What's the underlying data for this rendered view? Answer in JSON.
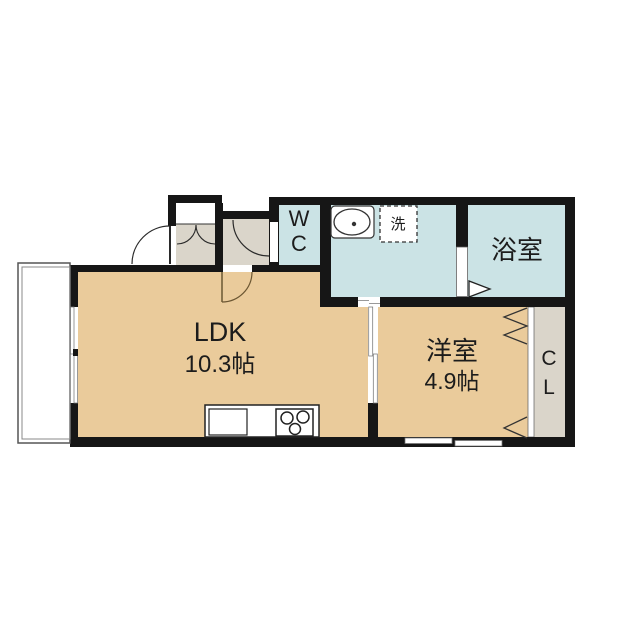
{
  "plan": {
    "ldk": {
      "label": "LDK",
      "area": "10.3帖"
    },
    "western_room": {
      "label": "洋室",
      "area": "4.9帖"
    },
    "bath": {
      "label": "浴室"
    },
    "wc": {
      "line1": "W",
      "line2": "C"
    },
    "closet": {
      "line1": "C",
      "line2": "L"
    },
    "laundry": {
      "label": "洗"
    }
  },
  "colors": {
    "room_tan": "#EACB9B",
    "wet_area_blue": "#CBE3E5",
    "hall_gray": "#DAD5CA",
    "wall_black": "#161616",
    "line_dark": "#2a2a2a",
    "door_arc_brown": "#6b5632"
  }
}
